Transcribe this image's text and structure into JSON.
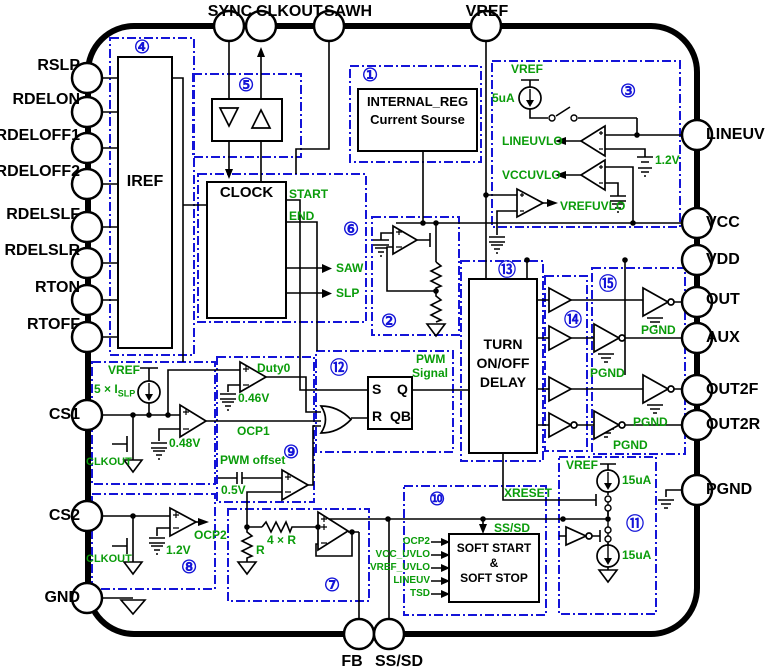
{
  "colors": {
    "outline": "#000000",
    "box_dash_blue": "#1414d8",
    "signal_green": "#0a9c0a",
    "background": "#ffffff"
  },
  "pins": {
    "top": [
      {
        "label": "SYNC"
      },
      {
        "label": "CLKOUT"
      },
      {
        "label": "SAWH"
      },
      {
        "label": "VREF"
      }
    ],
    "left": [
      {
        "label": "RSLP"
      },
      {
        "label": "RDELON"
      },
      {
        "label": "RDELOFF1"
      },
      {
        "label": "RDELOFF2"
      },
      {
        "label": "RDELSLF"
      },
      {
        "label": "RDELSLR"
      },
      {
        "label": "RTON"
      },
      {
        "label": "RTOFF"
      },
      {
        "label": "CS1"
      },
      {
        "label": "CS2"
      },
      {
        "label": "GND"
      }
    ],
    "right": [
      {
        "label": "LINEUV"
      },
      {
        "label": "VCC"
      },
      {
        "label": "VDD"
      },
      {
        "label": "OUT"
      },
      {
        "label": "AUX"
      },
      {
        "label": "OUT2F"
      },
      {
        "label": "OUT2R"
      },
      {
        "label": "PGND"
      }
    ],
    "bottom": [
      {
        "label": "FB"
      },
      {
        "label": "SS/SD"
      }
    ]
  },
  "blocks": {
    "internal_reg": {
      "num": "①",
      "line1": "INTERNAL_REG",
      "line2": "Current Sourse"
    },
    "reg_output": {
      "num": "②"
    },
    "uvlo": {
      "num": "③",
      "vref": "VREF",
      "bias": "5uA",
      "lineuvlo": "LINEUVLO",
      "vccuvlo": "VCCUVLO",
      "vrefuvlo": "VREFUVLO",
      "vth": "1.2V"
    },
    "iref": {
      "num": "④",
      "title": "IREF"
    },
    "sync_buffer": {
      "num": "⑤"
    },
    "clock": {
      "num": "⑥",
      "title": "CLOCK",
      "start": "START",
      "end": "END",
      "saw": "SAW",
      "slp": "SLP"
    },
    "feedback_amp": {
      "num": "⑦",
      "r": "R",
      "r4": "4 × R"
    },
    "current_sense": {
      "num": "⑧",
      "vref": "VREF",
      "islp_prefix": "5 ×",
      "islp_base": "I",
      "islp_sub": "SLP",
      "clkout_cs1": "CLKOUT",
      "vth_cs1": "0.48V",
      "clkout_cs2": "CLKOUT",
      "vth_cs2": "1.2V",
      "ocp2": "OCP2"
    },
    "pwm_comparators": {
      "num": "⑨",
      "duty0": "Duty0",
      "duty_vth": "0.46V",
      "ocp1": "OCP1",
      "pwm_offset": "PWM offset",
      "offset_v": "0.5V"
    },
    "soft_start": {
      "num": "⑩",
      "line1": "SOFT START",
      "line2": "&",
      "line3": "SOFT STOP",
      "xreset": "XRESET",
      "sssd": "SS/SD",
      "inputs": [
        {
          "label": "OCP2"
        },
        {
          "label": "VCC_UVLO"
        },
        {
          "label": "VREF_UVLO"
        },
        {
          "label": "LINEUV"
        },
        {
          "label": "TSD"
        }
      ]
    },
    "ss_current": {
      "num": "⑪",
      "vref": "VREF",
      "i_charge": "15uA",
      "i_discharge": "15uA"
    },
    "pwm_latch": {
      "num": "⑫",
      "s": "S",
      "q": "Q",
      "r": "R",
      "qb": "QB",
      "out_line1": "PWM",
      "out_line2": "Signal"
    },
    "delay": {
      "num": "⑬",
      "line1": "TURN",
      "line2": "ON/OFF",
      "line3": "DELAY"
    },
    "predrivers": {
      "num": "⑭"
    },
    "drivers": {
      "num": "⑮",
      "pgnd": [
        "PGND",
        "PGND",
        "PGND",
        "PGND"
      ]
    }
  }
}
